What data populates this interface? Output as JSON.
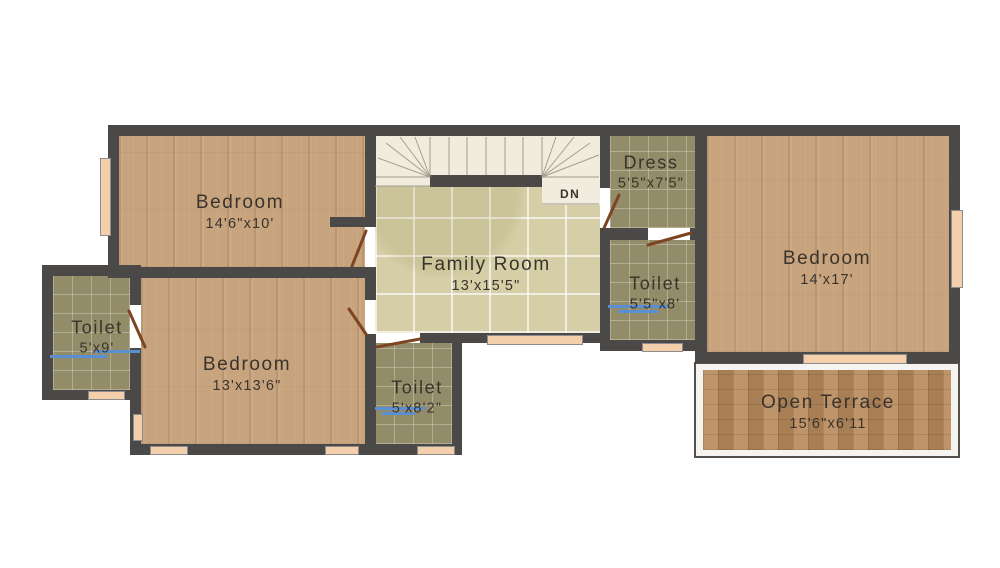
{
  "floorplan": {
    "rooms": [
      {
        "id": "bedroom-top-left",
        "label": "Bedroom",
        "dims": "14'6\"x10'"
      },
      {
        "id": "family-room",
        "label": "Family Room",
        "dims": "13'x15'5\""
      },
      {
        "id": "dress",
        "label": "Dress",
        "dims": "5'5\"x7'5\""
      },
      {
        "id": "toilet-mid",
        "label": "Toilet",
        "dims": "5'5\"x8'"
      },
      {
        "id": "bedroom-right",
        "label": "Bedroom",
        "dims": "14'x17'"
      },
      {
        "id": "toilet-left",
        "label": "Toilet",
        "dims": "5'x9'"
      },
      {
        "id": "bedroom-middle",
        "label": "Bedroom",
        "dims": "13'x13'6\""
      },
      {
        "id": "toilet-bottom",
        "label": "Toilet",
        "dims": "5'x8'2\""
      },
      {
        "id": "open-terrace",
        "label": "Open Terrace",
        "dims": "15'6\"x6'11"
      }
    ],
    "stairs_label": "DN",
    "colors": {
      "wall": "#4a4947",
      "wood_floor": "#c7a47e",
      "family_tile": "#d5cea6",
      "bath_tile": "#938c68",
      "terrace_brick": "#b98b5d",
      "stairs": "#f2ecdf",
      "window_sill": "#f4cfac",
      "door_leaf": "#7d4424",
      "fixture_blue": "#5b8fd4",
      "text": "#3a332b",
      "background": "#ffffff"
    }
  }
}
